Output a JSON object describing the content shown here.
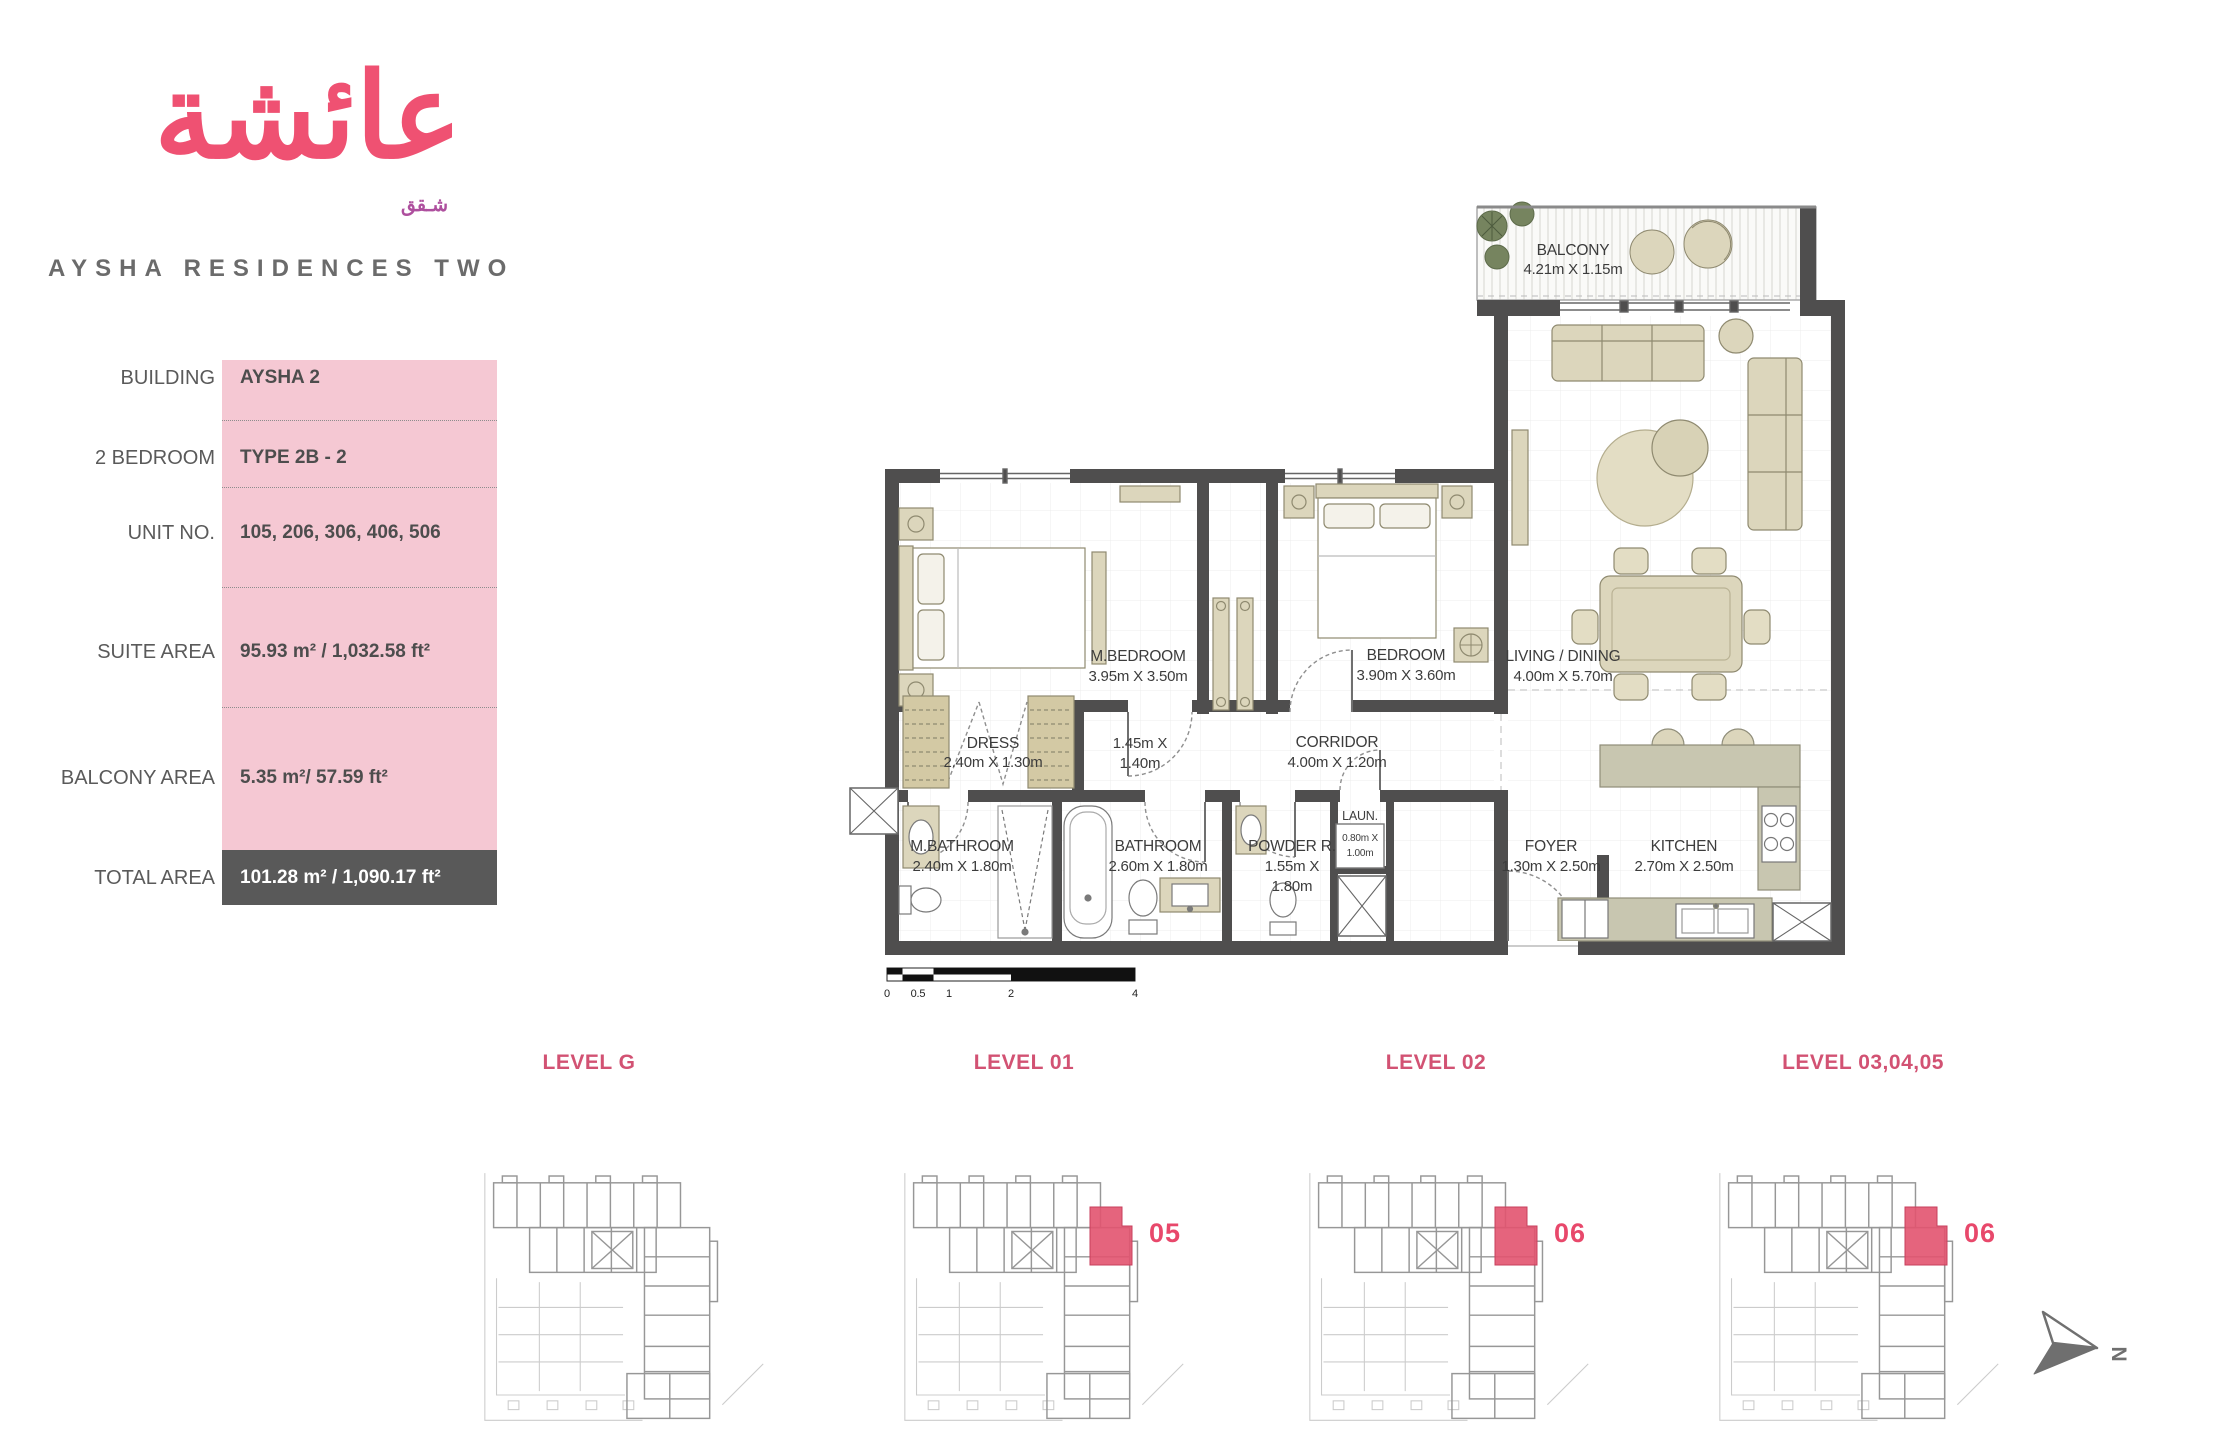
{
  "logo": {
    "arabic_name": "عائشة",
    "arabic_sub": "شـقق",
    "title": "AYSHA RESIDENCES TWO"
  },
  "info_table": {
    "rows": [
      {
        "label": "BUILDING",
        "value": "AYSHA 2"
      },
      {
        "label": "2 BEDROOM",
        "value": "TYPE 2B - 2"
      },
      {
        "label": "UNIT NO.",
        "value": "105, 206, 306, 406, 506"
      },
      {
        "label": "SUITE AREA",
        "value": "95.93 m² / 1,032.58 ft²"
      },
      {
        "label": "BALCONY AREA",
        "value": "5.35 m²/ 57.59 ft²"
      },
      {
        "label": "TOTAL AREA",
        "value": "101.28 m² / 1,090.17 ft²"
      }
    ]
  },
  "floor_plan": {
    "rooms": {
      "balcony": {
        "name": "BALCONY",
        "dims": "4.21m X 1.15m"
      },
      "m_bedroom": {
        "name": "M.BEDROOM",
        "dims": "3.95m X 3.50m"
      },
      "bedroom": {
        "name": "BEDROOM",
        "dims": "3.90m X 3.60m"
      },
      "living": {
        "name": "LIVING / DINING",
        "dims": "4.00m X 5.70m"
      },
      "dress": {
        "name": "DRESS",
        "dims": "2.40m X 1.30m"
      },
      "hall": {
        "dims_l1": "1.45m X",
        "dims_l2": "1.40m"
      },
      "corridor": {
        "name": "CORRIDOR",
        "dims": "4.00m X 1.20m"
      },
      "m_bathroom": {
        "name": "M.BATHROOM",
        "dims": "2.40m X 1.80m"
      },
      "bathroom": {
        "name": "BATHROOM",
        "dims": "2.60m X 1.80m"
      },
      "powder": {
        "name": "POWDER R.",
        "dims_l1": "1.55m X",
        "dims_l2": "1.80m"
      },
      "laundry": {
        "name": "LAUN.",
        "dims_l1": "0.80m X",
        "dims_l2": "1.00m"
      },
      "foyer": {
        "name": "FOYER",
        "dims": "1.30m X 2.50m"
      },
      "kitchen": {
        "name": "KITCHEN",
        "dims": "2.70m X 2.50m"
      }
    },
    "scale_bar": {
      "ticks": [
        "0",
        "0.5",
        "1",
        "2",
        "4"
      ]
    }
  },
  "levels": [
    {
      "label": "LEVEL G",
      "unit": ""
    },
    {
      "label": "LEVEL 01",
      "unit": "05"
    },
    {
      "label": "LEVEL 02",
      "unit": "06"
    },
    {
      "label": "LEVEL 03,04,05",
      "unit": "06"
    }
  ],
  "compass": {
    "label": "N"
  },
  "colors": {
    "logo_pink": "#ef5172",
    "logo_sub_purple": "#ae4f9e",
    "panel_pink": "#f5c8d3",
    "total_row_gray": "#595959",
    "level_label_pink": "#d25273",
    "unit_badge_pink": "#e8486b",
    "highlight_unit": "#e2536f",
    "wall_gray": "#4f4e4e",
    "furniture_tan": "#dcd6bc"
  }
}
